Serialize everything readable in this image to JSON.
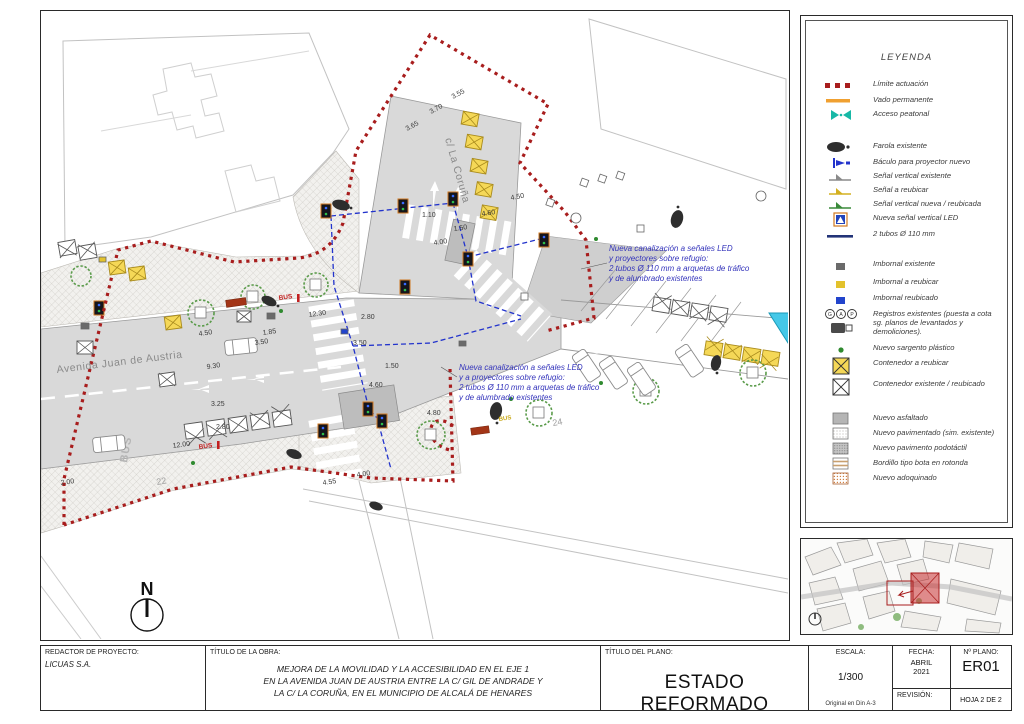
{
  "colors": {
    "limit_red": "#a81d1d",
    "annotation_blue": "#3333bb",
    "canalization_blue": "#2233cc",
    "container_yellow": "#f5d857",
    "access_teal": "#17b8a6",
    "vado_orange": "#f0a030",
    "cyan_marker": "#45c8e8",
    "road_gray": "#d9d9d9"
  },
  "drawing": {
    "north_label": "N",
    "streets": {
      "avenida": "Avenida Juan de Austria",
      "coruna": "c/ La Coruña"
    },
    "labels": {
      "bus": "BUS",
      "house_22": "22",
      "house_24": "24"
    },
    "annotations": [
      {
        "lines": [
          "Nueva canalización a señales LED",
          "y proyectores sobre refugio:",
          "2 tubos Ø 110 mm a arquetas de tráfico",
          "y de alumbrado existentes"
        ]
      },
      {
        "lines": [
          "Nueva canalización a señales LED",
          "y a proyectores sobre refugio:",
          "2 tubos Ø 110 mm a arquetas de tráfico",
          "y de alumbrado existentes"
        ]
      }
    ],
    "dims": [
      "3.55",
      "3.70",
      "3.65",
      "4.50",
      "4.60",
      "1.10",
      "1.50",
      "4.00",
      "4.50",
      "1.85",
      "3.50",
      "9.30",
      "12.30",
      "2.80",
      "3.50",
      "1.50",
      "3.25",
      "2.80",
      "12.00",
      "2.00",
      "4.55",
      "4.00",
      "4.80",
      "4.60"
    ]
  },
  "legend": {
    "title": "LEYENDA",
    "items": [
      {
        "icon": "limite-actuacion",
        "label": "Límite actuación"
      },
      {
        "icon": "vado-permanente",
        "label": "Vado permanente"
      },
      {
        "icon": "acceso-peatonal",
        "label": "Acceso peatonal"
      },
      {
        "icon": "farola-existente",
        "label": "Farola existente"
      },
      {
        "icon": "baculo-proyector-nuevo",
        "label": "Báculo para proyector nuevo"
      },
      {
        "icon": "senal-vertical-existente",
        "label": "Señal vertical existente"
      },
      {
        "icon": "senal-a-reubicar",
        "label": "Señal a reubicar"
      },
      {
        "icon": "senal-vertical-nueva",
        "label": "Señal vertical nueva / reubicada"
      },
      {
        "icon": "nueva-senal-vertical-led",
        "label": "Nueva señal vertical LED"
      },
      {
        "icon": "dos-tubos-110",
        "label": "2 tubos Ø 110 mm"
      },
      {
        "icon": "imbornal-existente",
        "label": "Imbornal existente"
      },
      {
        "icon": "imbornal-a-reubicar",
        "label": "Imbornal a reubicar"
      },
      {
        "icon": "imbornal-reubicado",
        "label": "Imbornal reubicado"
      },
      {
        "icon": "registros-existentes",
        "label": "Registros existentes (puesta a cota sg. planos de levantados y demoliciones)."
      },
      {
        "icon": "nuevo-sargento-plastico",
        "label": "Nuevo sargento plástico"
      },
      {
        "icon": "contenedor-a-reubicar",
        "label": "Contenedor a reubicar"
      },
      {
        "icon": "contenedor-existente",
        "label": "Contenedor existente / reubicado"
      },
      {
        "icon": "nuevo-asfaltado",
        "label": "Nuevo asfaltado"
      },
      {
        "icon": "nuevo-pavimentado",
        "label": "Nuevo pavimentado (sim. existente)"
      },
      {
        "icon": "nuevo-pavimento-podotactil",
        "label": "Nuevo pavimento podotáctil"
      },
      {
        "icon": "bordillo-bota-rotonda",
        "label": "Bordillo tipo bota en rotonda"
      },
      {
        "icon": "nuevo-adoquinado",
        "label": "Nuevo adoquinado"
      }
    ]
  },
  "titleblock": {
    "redactor_label": "REDACTOR DE PROYECTO:",
    "redactor_value": "LICUAS S.A.",
    "obra_label": "TÍTULO DE LA OBRA:",
    "obra_line1": "MEJORA DE LA MOVILIDAD Y LA ACCESIBILIDAD EN EL EJE 1",
    "obra_line2": "EN LA AVENIDA JUAN DE AUSTRIA ENTRE LA C/ GIL DE ANDRADE Y",
    "obra_line3": "LA C/ LA CORUÑA, EN EL MUNICIPIO DE ALCALÁ DE HENARES",
    "plano_label": "TÍTULO DEL PLANO:",
    "plano_value": "ESTADO REFORMADO",
    "escala_label": "ESCALA:",
    "escala_value": "1/300",
    "escala_note": "Original en Din A-3",
    "fecha_label": "FECHA:",
    "fecha_line1": "ABRIL",
    "fecha_line2": "2021",
    "nplano_label": "Nº PLANO:",
    "nplano_value": "ER01",
    "revision_label": "REVISIÓN:",
    "hoja_value": "HOJA 2 DE 2"
  }
}
